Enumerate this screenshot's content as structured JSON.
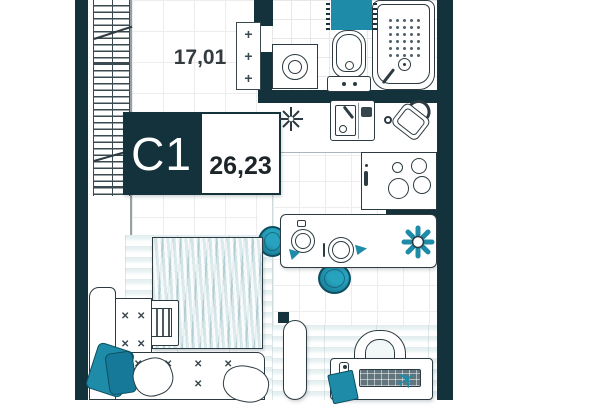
{
  "plan_card": {
    "unit_code": "C1",
    "unit_total_area": "26,23",
    "room_area_label": "17,01"
  },
  "glyphs": {
    "radiator_plus": "+",
    "sofa_tuft": "✕",
    "toy_plane": "✈"
  },
  "colors": {
    "wall": "#14323b",
    "accent_teal": "#1e8ca8",
    "accent_teal_dark": "#0d4f60",
    "outline": "#2c3b41",
    "floor_stripe": "#e3edef",
    "grid_line": "#ececec"
  },
  "fixtures": [
    "panoramic-window",
    "radiator",
    "washing-machine",
    "toilet",
    "bathtub",
    "bath-mat",
    "kitchen-sink",
    "kettle",
    "stove",
    "bar-counter",
    "plate-setting",
    "plant",
    "stool",
    "bed",
    "nightstand",
    "corner-sofa",
    "pillow",
    "plaid",
    "door",
    "desk-chair",
    "desk",
    "keyboard",
    "notebook",
    "toy-plane",
    "ceiling-lamp"
  ]
}
